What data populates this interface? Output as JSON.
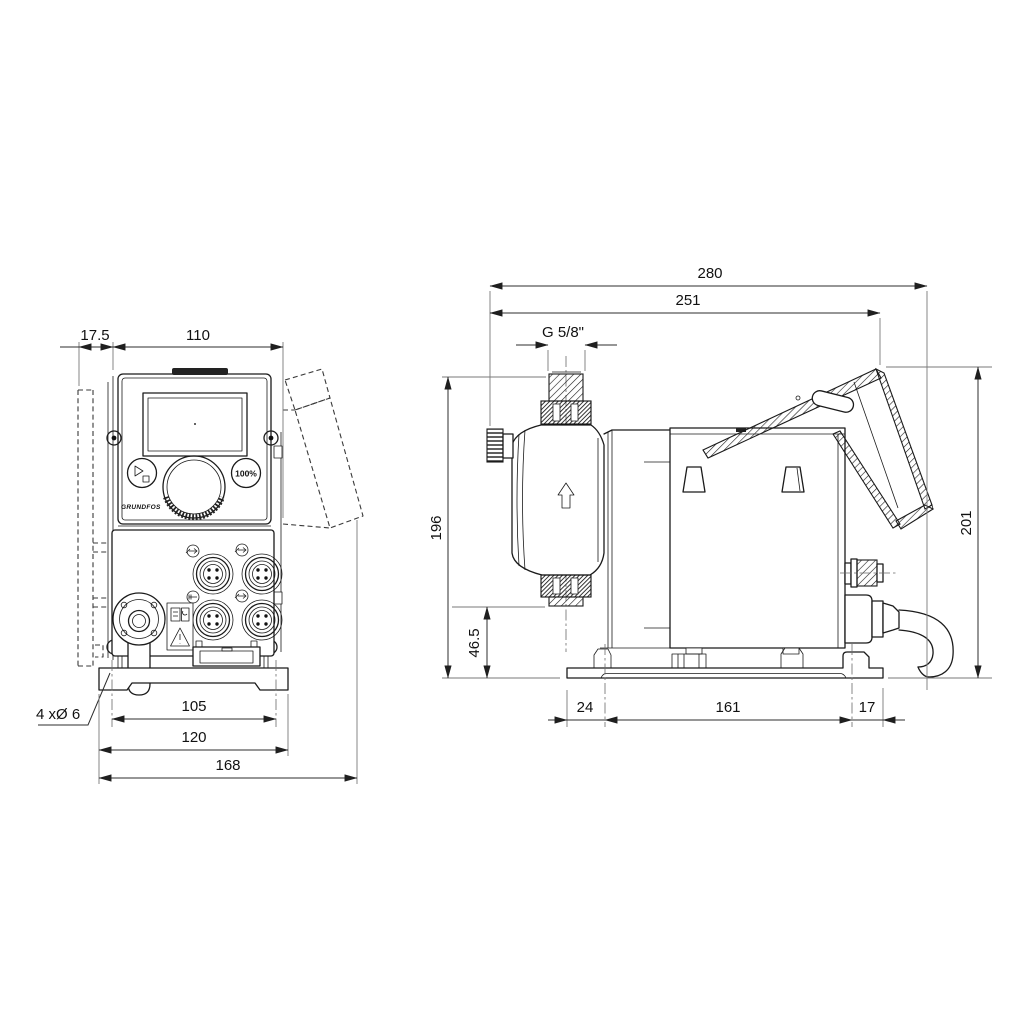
{
  "front_view": {
    "dim_wall_offset": "17.5",
    "dim_unit_width": "110",
    "hole_callout": "4 xØ 6",
    "dim_hole_spacing": "105",
    "dim_base_width": "120",
    "dim_overall_width": "168",
    "percent_button": "100%",
    "brand": "GRUNDFOS"
  },
  "side_view": {
    "dim_overall_depth": "280",
    "dim_body_depth": "251",
    "thread_size": "G 5/8\"",
    "dim_height_to_discharge": "196",
    "dim_suction_height": "46.5",
    "dim_overall_height": "201",
    "dim_base_front_offset": "24",
    "dim_base_hole_spacing": "161",
    "dim_base_rear_offset": "17"
  }
}
